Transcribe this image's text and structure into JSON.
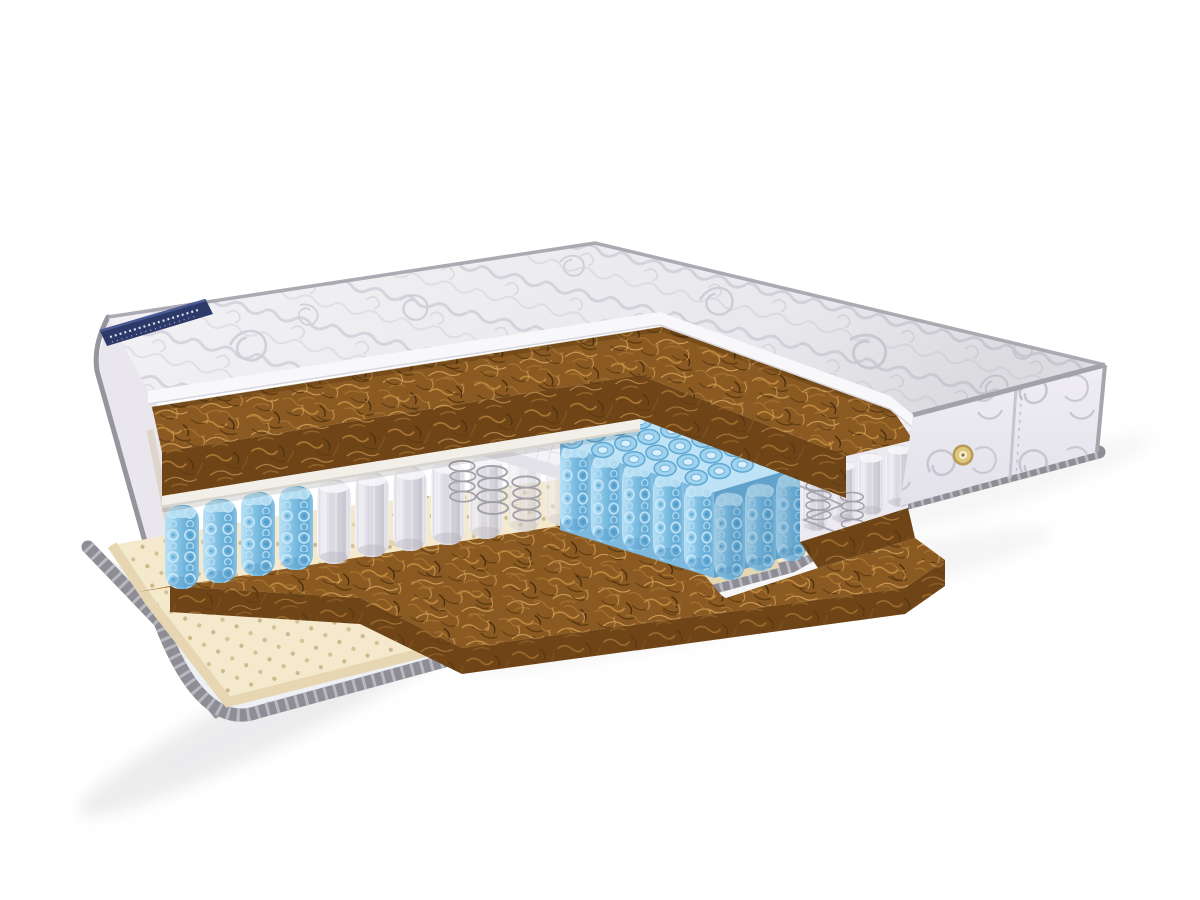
{
  "image": {
    "kind": "product-photo",
    "subject": "orthopedic mattress cross-section cutaway on white background",
    "background": "#ffffff"
  },
  "brand_label": {
    "text": "",
    "legibility": "stitched cursive text present but illegible",
    "color": "#2d3a69"
  },
  "air_vent_button": {
    "color": "#dfc87e",
    "rim_color": "#b59b55"
  },
  "layers": [
    {
      "id": "quilted-top-cover",
      "material": "quilted fabric",
      "color": "#f3f2f5"
    },
    {
      "id": "foam-edge",
      "material": "foam under quilting",
      "color": "#f8f8fa"
    },
    {
      "id": "coconut-coir-upper",
      "material": "coconut coir",
      "color": "#8a5a22"
    },
    {
      "id": "felt-spacer",
      "material": "felt",
      "color": "#f2efe8"
    },
    {
      "id": "pocket-springs-blue",
      "material": "knit pocket springs",
      "color": "#7db9de"
    },
    {
      "id": "pocket-springs-white",
      "material": "nonwoven pocket springs",
      "color": "#eceaf0"
    },
    {
      "id": "steel-coils",
      "material": "bare steel coils",
      "color": "#a2a0a8"
    },
    {
      "id": "mesh-slab",
      "material": "spacer mesh sheet",
      "color": "#f4f4f8"
    },
    {
      "id": "coconut-coir-lower",
      "material": "coconut coir",
      "color": "#8a5a22"
    },
    {
      "id": "latex-perforated",
      "material": "perforated latex",
      "color": "#f4e9cc"
    },
    {
      "id": "quilted-bottom-cover",
      "material": "quilted fabric",
      "color": "#eef0f5"
    },
    {
      "id": "side-panel-damask",
      "material": "damask side panel",
      "color": "#eceaf1"
    },
    {
      "id": "edge-binding-tape",
      "material": "striped binding tape",
      "color": "#8e8c94"
    }
  ],
  "colors": {
    "background": "#ffffff",
    "quilt_fabric": "#f3f2f5",
    "foam_edge": "#f8f8fa",
    "piping": "#a3a1aa",
    "silhouette_piping": "#96949c",
    "label_navy": "#2d3a69",
    "coir_top": "#8a5a22",
    "coir_face": "#6f4517",
    "felt": "#f2efe8",
    "spring_blue": "#7db9de",
    "spring_white": "#eceaf0",
    "steel_wire": "#a2a0a8",
    "mesh_slab": "#f4f4f8",
    "latex": "#f4e9cc",
    "latex_edge": "#e6d7b2",
    "bottom_cover": "#eef0f5",
    "binding": "#8e8c94",
    "side_panel": "#eceaf1",
    "left_face": "#e9e7ed",
    "vent_gold": "#dfc87e",
    "shadow": "#e3e3e5"
  }
}
